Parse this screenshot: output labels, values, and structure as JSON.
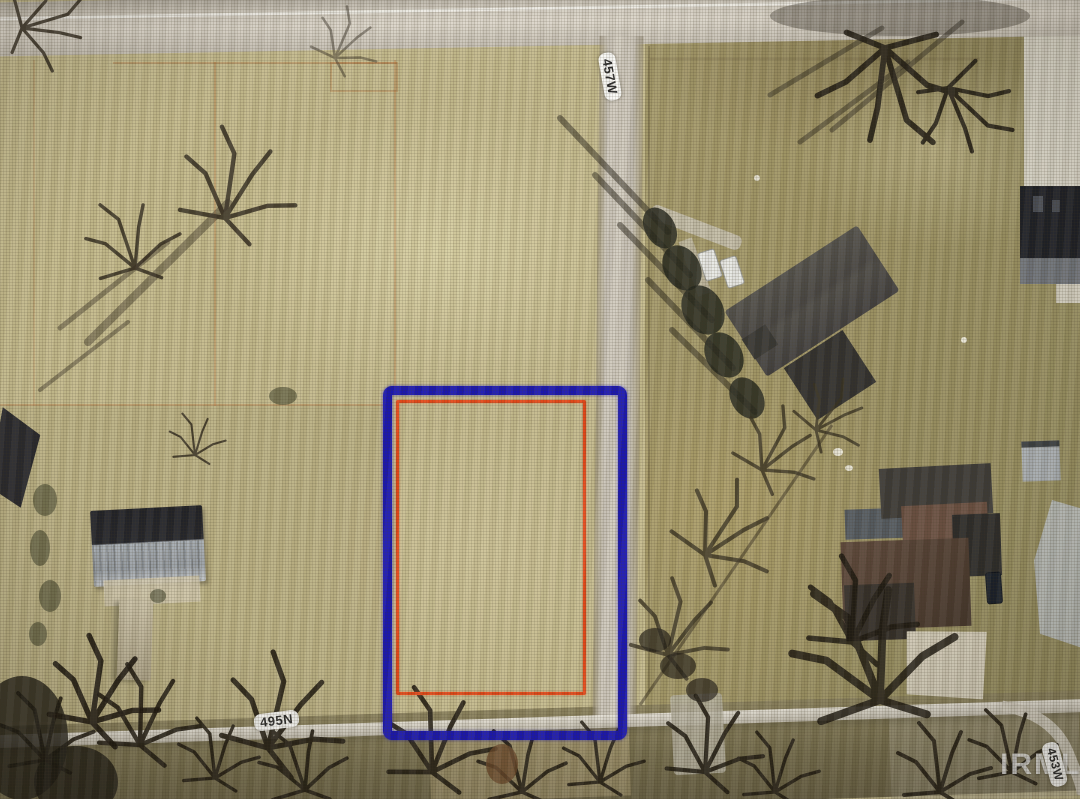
{
  "meta": {
    "title": "Aerial parcel map photo",
    "width_px": 1080,
    "height_px": 799
  },
  "labels": {
    "road_vertical": "457W",
    "road_bottom": "495N",
    "road_right_edge": "453W"
  },
  "watermark": {
    "text": "IRMLS"
  },
  "parcel_outlines": {
    "outer_color": "#1c18b2",
    "inner_color": "#e64a1a"
  },
  "palette": {
    "field_left": "#c5bb8e",
    "field_right": "#a29767",
    "road": "#d0cabe",
    "bottom_field": "#78704f"
  }
}
